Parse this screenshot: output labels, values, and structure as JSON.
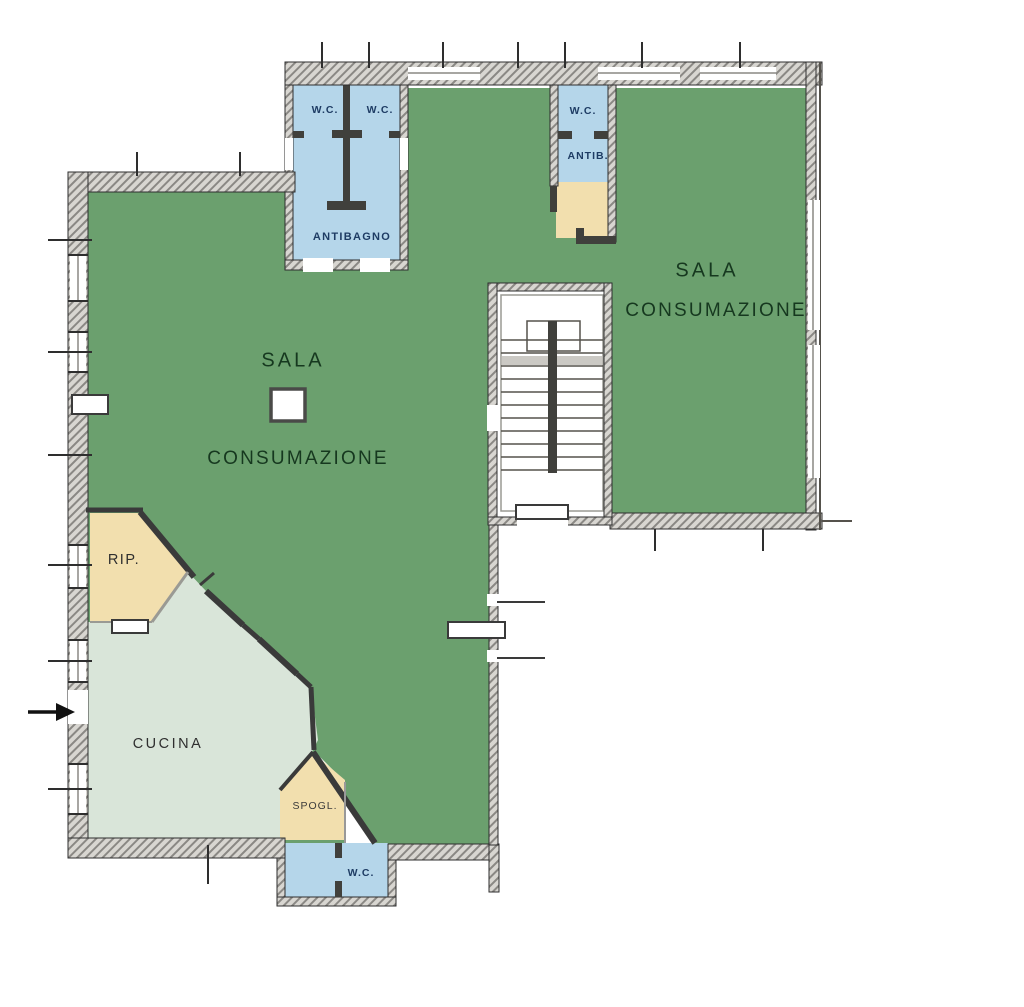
{
  "plan": {
    "title": "restaurant-floor-plan",
    "labels": {
      "wc_top_left": "W.C.",
      "wc_top_center": "W.C.",
      "antibagno": "ANTIBAGNO",
      "wc_top_right": "W.C.",
      "antib": "ANTIB.",
      "sala_left_1": "SALA",
      "sala_left_2": "CONSUMAZIONE",
      "sala_right_1": "SALA",
      "sala_right_2": "CONSUMAZIONE",
      "rip": "RIP.",
      "cucina": "CUCINA",
      "spogl": "SPOGL.",
      "wc_bottom": "W.C."
    },
    "colors": {
      "sala": "#6ba06e",
      "cucina": "#d9e5d9",
      "wc": "#b5d6ea",
      "storage": "#f2dfae",
      "wall_dark": "#3a3a3a",
      "label_blue": "#1e3c64",
      "label_green": "#16381f",
      "label_dark": "#2f2f2f"
    },
    "entrance": {
      "symbol": "arrow-right"
    }
  }
}
